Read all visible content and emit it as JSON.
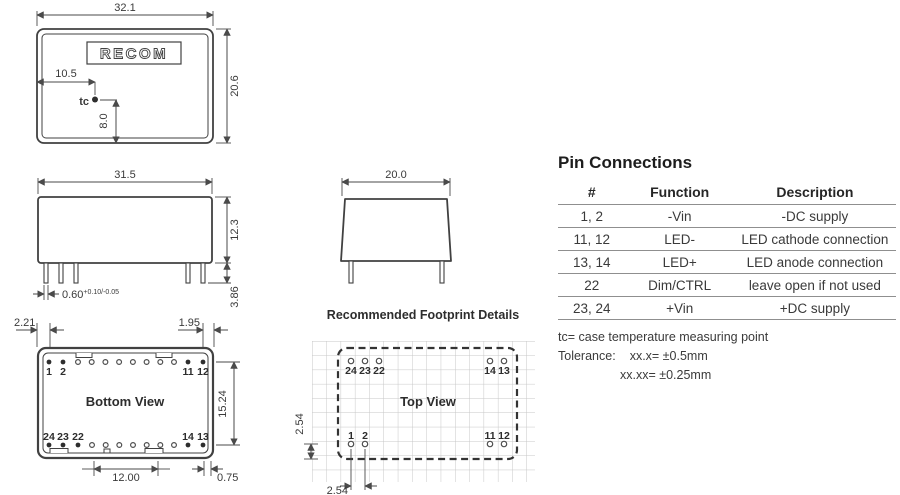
{
  "colors": {
    "line": "#414141",
    "text": "#3a3a3a",
    "grid": "#c7c7c7",
    "table_line": "#8f8f8f"
  },
  "top_view": {
    "logo": "RECOM",
    "width": "32.1",
    "height": "20.6",
    "tc_x": "10.5",
    "tc_y": "8.0",
    "tc": "tc"
  },
  "side_view": {
    "width": "31.5",
    "height": "12.3",
    "pin_width": "0.60",
    "pin_width_tol": "+0.10/-0.05",
    "pin_length": "3.86"
  },
  "front_view": {
    "width": "20.0"
  },
  "bottom_view": {
    "title": "Bottom View",
    "left_offset": "2.21",
    "right_offset": "1.95",
    "pin_row_span": "15.24",
    "pin_span": "12.00",
    "edge_offset": "0.75",
    "top_pins": {
      "p1": "1",
      "p2": "2",
      "p11": "11",
      "p12": "12"
    },
    "bottom_pins": {
      "p24": "24",
      "p23": "23",
      "p22": "22",
      "p14": "14",
      "p13": "13"
    }
  },
  "footprint": {
    "heading": "Recommended Footprint Details",
    "title": "Top View",
    "pitch_v": "2.54",
    "pitch_h": "2.54",
    "top_pins": {
      "p24": "24",
      "p23": "23",
      "p22": "22",
      "p14": "14",
      "p13": "13"
    },
    "bottom_pins": {
      "p1": "1",
      "p2": "2",
      "p11": "11",
      "p12": "12"
    }
  },
  "pin_table": {
    "title": "Pin Connections",
    "headers": [
      "#",
      "Function",
      "Description"
    ],
    "rows": [
      [
        "1, 2",
        "-Vin",
        "-DC supply"
      ],
      [
        "11, 12",
        "LED-",
        "LED cathode connection"
      ],
      [
        "13, 14",
        "LED+",
        "LED anode connection"
      ],
      [
        "22",
        "Dim/CTRL",
        "leave open if not used"
      ],
      [
        "23, 24",
        "+Vin",
        "+DC supply"
      ]
    ],
    "note_tc": "tc= case temperature measuring point",
    "tolerance_label": "Tolerance:",
    "tolerance_1": "xx.x= ±0.5mm",
    "tolerance_2": "xx.xx= ±0.25mm"
  }
}
